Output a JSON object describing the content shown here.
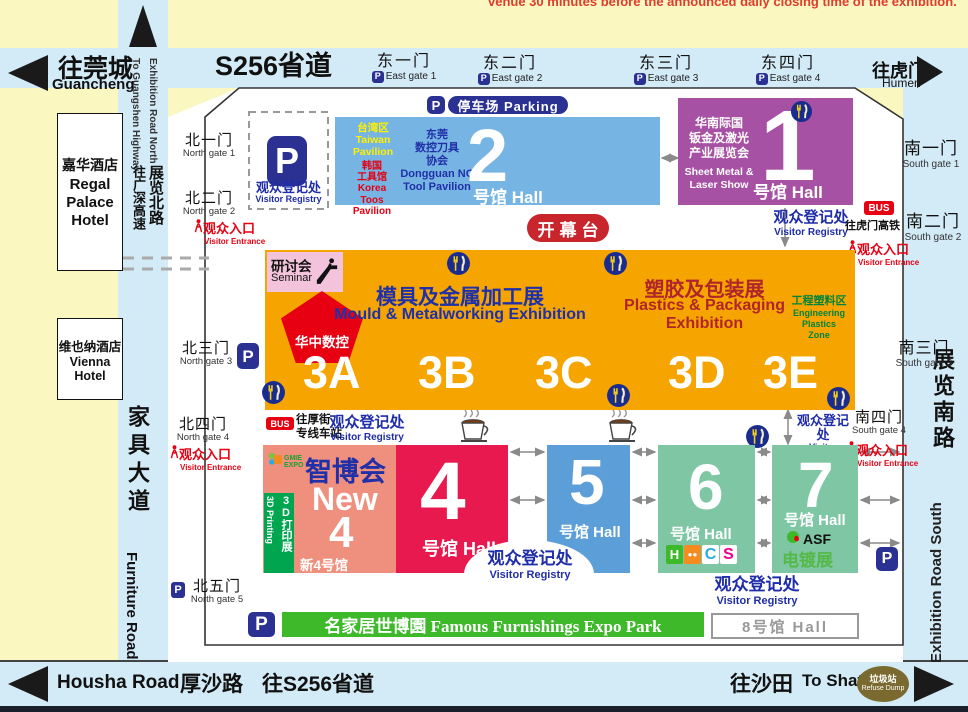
{
  "notice": "venue 30 minutes before the announced daily closing time of the exhibition.",
  "colors": {
    "background": "#FBF7C0",
    "road": "#D3EAF7",
    "hall1": "#A651A3",
    "hall2": "#76B4E3",
    "hall3": "#F6A500",
    "hall4": "#E7194E",
    "new4": "#EF8F7E",
    "hall5": "#5B9ED8",
    "hall67": "#7EC6A4",
    "famous_bar": "#3DB92A",
    "parking_navy": "#2A3192",
    "red": "#E60012"
  },
  "labels": {
    "p": "P",
    "registry": {
      "zh": "观众登记处",
      "en": "Visitor Registry"
    },
    "entrance": {
      "zh": "观众入口",
      "en": "Visitor Entrance"
    },
    "parking": "停车场 Parking",
    "opening": "开幕台",
    "hall_suffix": "号馆 Hall",
    "bus": "BUS",
    "bus_humen_rail": "往虎门高铁",
    "bus_houjie1": "往厚街",
    "bus_houjie2": "专线车站"
  },
  "roads": {
    "s256": "S256省道",
    "guancheng": {
      "zh": "往莞城",
      "en": "Guancheng"
    },
    "humen": {
      "zh": "往虎门",
      "en": "Humen"
    },
    "north_road": {
      "en1": "Exhibition Road North",
      "en2": "To Guangshen Highway",
      "zh1": "展览北路",
      "zh2": "往广深高速"
    },
    "furniture": {
      "zh": "家具大道",
      "en": "Furniture Road"
    },
    "south_road": {
      "zh": "展览南路",
      "en": "Exhibition Road South"
    },
    "housha": {
      "en": "Housha Road",
      "zh": "厚沙路",
      "zh2": "往S256省道"
    },
    "shatian": {
      "zh": "往沙田",
      "en": "To Shatian"
    },
    "refuse": {
      "zh": "垃圾站",
      "en": "Refuse Dump"
    }
  },
  "hotels": {
    "regal": {
      "zh": "嘉华酒店",
      "en1": "Regal",
      "en2": "Palace",
      "en3": "Hotel"
    },
    "vienna": {
      "zh": "维也纳酒店",
      "en": "Vienna Hotel"
    }
  },
  "gates": {
    "east": [
      {
        "zh": "东一门",
        "en": "East gate 1"
      },
      {
        "zh": "东二门",
        "en": "East gate 2"
      },
      {
        "zh": "东三门",
        "en": "East gate 3"
      },
      {
        "zh": "东四门",
        "en": "East gate 4"
      }
    ],
    "north": [
      {
        "zh": "北一门",
        "en": "North gate 1"
      },
      {
        "zh": "北二门",
        "en": "North gate 2"
      },
      {
        "zh": "北三门",
        "en": "North gate 3"
      },
      {
        "zh": "北四门",
        "en": "North gate 4"
      },
      {
        "zh": "北五门",
        "en": "North gate 5"
      }
    ],
    "south": [
      {
        "zh": "南一门",
        "en": "South gate 1"
      },
      {
        "zh": "南二门",
        "en": "South gate 2"
      },
      {
        "zh": "南三门",
        "en": "South gate 3"
      },
      {
        "zh": "南四门",
        "en": "South gate 4"
      }
    ]
  },
  "halls": {
    "h1": {
      "num": "1",
      "zh1": "华南际国",
      "zh2": "钣金及激光",
      "zh3": "产业展览会",
      "en1": "Sheet Metal &",
      "en2": "Laser Show"
    },
    "h2": {
      "num": "2",
      "taiwan": [
        "台湾区",
        "Taiwan",
        "Pavilion"
      ],
      "korea": [
        "韩国",
        "工具馆",
        "Korea",
        "Toos Pavilion"
      ],
      "dongguan": [
        "东莞",
        "数控刀具",
        "协会",
        "Dongguan NC",
        "Tool Pavilion"
      ]
    },
    "h3": {
      "sections": [
        "3A",
        "3B",
        "3C",
        "3D",
        "3E"
      ],
      "mould_zh": "模具及金属加工展",
      "mould_en": "Mould & Metalworking Exhibition",
      "plastics_zh": "塑胶及包装展",
      "plastics_en1": "Plastics & Packaging",
      "plastics_en2": "Exhibition",
      "eng_zh": "工程塑料区",
      "eng_en1": "Engineering Plastics",
      "eng_en2": "Zone",
      "seminar_zh": "研讨会",
      "seminar_en": "Seminar",
      "cnc": "华中数控"
    },
    "new4": {
      "expo_logo": "GMIE EXPO",
      "expo": "智博会",
      "new_label": "New",
      "num": "4",
      "zh": "新4号馆",
      "printing_zh": "3D打印展",
      "printing_en": "3D Printing"
    },
    "h4": {
      "num": "4"
    },
    "h5": {
      "num": "5"
    },
    "h6": {
      "num": "6",
      "logo_parts": [
        "H",
        "C",
        "S"
      ]
    },
    "h7": {
      "num": "7",
      "asf": "ASF",
      "plating": "电镀展"
    },
    "h8": {
      "label": "8号馆 Hall"
    }
  },
  "famous": "名家居世博園 Famous Furnishings Expo Park"
}
